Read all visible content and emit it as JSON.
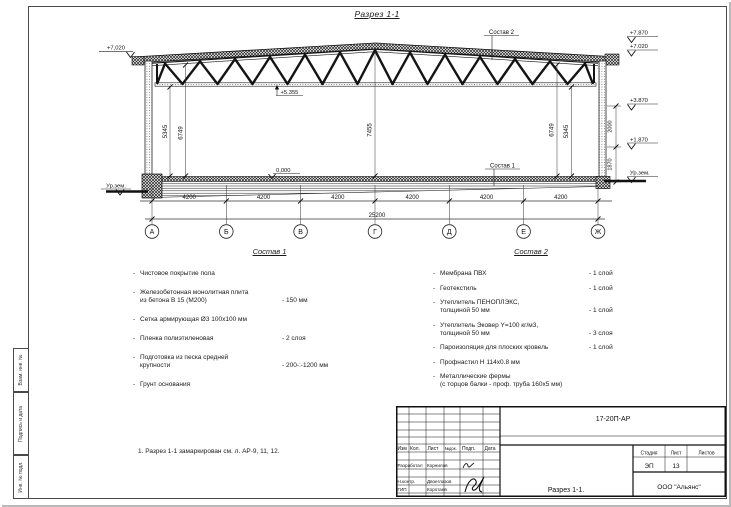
{
  "title": "Разрез 1-1",
  "note": "1. Разрез 1-1 замаркирован см. л. АР-9, 11, 12.",
  "margin_labels": {
    "box1": "Взам. инв. №",
    "box2": "Подпись и дата",
    "box3": "Инв. № подл."
  },
  "drawing": {
    "axes": {
      "a1": "А",
      "a2": "Б",
      "a3": "В",
      "a4": "Г",
      "a5": "Д",
      "a6": "Е",
      "a7": "Ж"
    },
    "bay": "4200",
    "total": "25200",
    "dims": {
      "left_inner": "5345",
      "left_outer": "6749",
      "center": "7455",
      "right_outer": "6749",
      "right_inner": "5345",
      "wall_upper": "2000",
      "wall_lower": "1870"
    },
    "elev": {
      "left_top": "+7,020",
      "left_ground": "Ур.зем.",
      "ridge": "+7.870",
      "eave": "+7.020",
      "mid": "+3.870",
      "low": "+1.870",
      "right_ground": "Ур.зем.",
      "truss_bottom": "+5.355",
      "floor": "0,000"
    },
    "refs": {
      "sostav1": "Состав 1",
      "sostav2": "Состав 2"
    }
  },
  "sostav1": {
    "title": "Состав 1",
    "items": [
      {
        "l1": "Чистовое покрытие пола",
        "l2": "",
        "qty": ""
      },
      {
        "l1": "Железобетонная  монолитная плита",
        "l2": "из бетона В 15 (М200)",
        "qty": "- 150 мм"
      },
      {
        "l1": "Сетка армирующая Ø3 100х100 мм",
        "l2": "",
        "qty": ""
      },
      {
        "l1": "Пленка полиэтиленовая",
        "l2": "",
        "qty": "- 2 слоя"
      },
      {
        "l1": "Подготовка из песка средней",
        "l2": "крупности",
        "qty": "- 200-:-1200 мм"
      },
      {
        "l1": "Грунт основания",
        "l2": "",
        "qty": ""
      }
    ]
  },
  "sostav2": {
    "title": "Состав 2",
    "items": [
      {
        "l1": "Мембрана ПВХ",
        "l2": "",
        "qty": "- 1 слой"
      },
      {
        "l1": "Геотекстиль",
        "l2": "",
        "qty": "- 1 слой"
      },
      {
        "l1": "Утеплитель ПЕНОПЛЭКС,",
        "l2": "толщиной 50 мм",
        "qty": "- 1 слой"
      },
      {
        "l1": "Утеплитель Эковер Y=100 кг/м3,",
        "l2": "толщиной 50 мм",
        "qty": "- 3 слоя"
      },
      {
        "l1": "Пароизоляция для плоских кровель",
        "l2": "",
        "qty": "- 1 слой"
      },
      {
        "l1": "Профнастил Н 114х0.8 мм",
        "l2": "",
        "qty": ""
      },
      {
        "l1": "Металлические фермы",
        "l2": "(с торцов балки - проф. труба 160х5 мм)",
        "qty": ""
      }
    ]
  },
  "titleblock": {
    "code": "17-20П-АР",
    "cols": {
      "c1": "Изм",
      "c2": "Кол.",
      "c3": "Лист",
      "c4": "№док.",
      "c5": "Подп.",
      "c6": "Дата"
    },
    "rows": {
      "r1_role": "Разработал",
      "r1_name": "Корнилов",
      "r2_role": "Н.контр.",
      "r2_name": "Двоеглазов",
      "r3_role": "ГИП",
      "r3_name": "Коротаев"
    },
    "stage_label": "Стадия",
    "sheet_label": "Лист",
    "sheets_label": "Листов",
    "stage": "ЭП",
    "sheet": "13",
    "sheets": "",
    "name": "Разрез 1-1.",
    "company": "ООО \"Альянс\""
  }
}
